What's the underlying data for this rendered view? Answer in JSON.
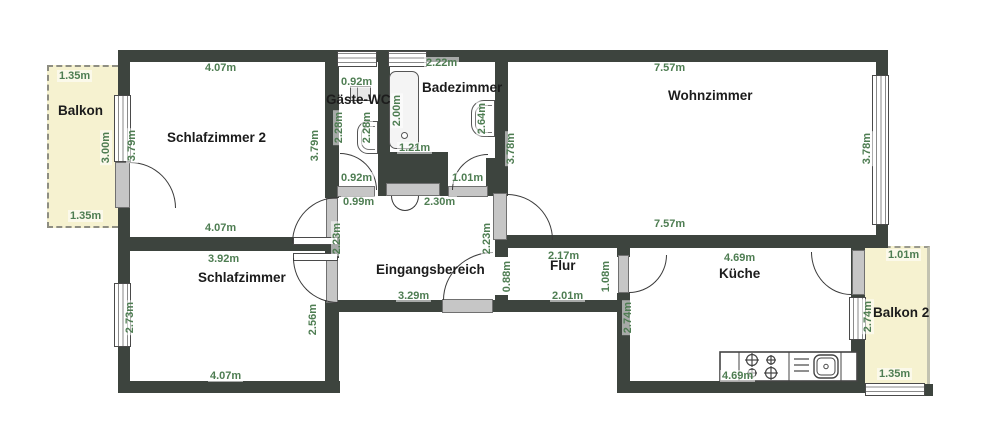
{
  "rooms": {
    "balkon": "Balkon",
    "schlafzimmer2": "Schlafzimmer 2",
    "gaeste_wc": "Gäste-WC",
    "badezimmer": "Badezimmer",
    "wohnzimmer": "Wohnzimmer",
    "eingangsbereich": "Eingangsbereich",
    "flur": "Flur",
    "kueche": "Küche",
    "schlafzimmer": "Schlafzimmer",
    "balkon2": "Balkon 2"
  },
  "dims": {
    "balkon_top": "1.35m",
    "balkon_right": "3.00m",
    "balkon_bottom": "1.35m",
    "sz2_top": "4.07m",
    "sz2_left": "3.79m",
    "sz2_right": "3.79m",
    "sz2_bottom": "4.07m",
    "wc_top": "0.92m",
    "wc_left": "2.28m",
    "wc_inner": "2.28m",
    "wc_bottom": "0.92m",
    "wc_door": "0.99m",
    "bad_top": "2.22m",
    "bad_tub": "2.00m",
    "bad_tub_w": "1.21m",
    "bad_right": "2.64m",
    "bad_bottom": "1.01m",
    "entry_top": "2.30m",
    "wz_top": "7.57m",
    "wz_left": "3.78m",
    "wz_right": "3.78m",
    "wz_bottom": "7.57m",
    "entry_left": "2.23m",
    "entry_right": "2.23m",
    "entry_bottom": "3.29m",
    "sz_top": "3.92m",
    "sz_left": "2.73m",
    "sz_right": "2.56m",
    "sz_bottom": "4.07m",
    "flur_top": "2.17m",
    "flur_left": "0.88m",
    "flur_right": "1.08m",
    "flur_bottom": "2.01m",
    "kueche_top": "4.69m",
    "kueche_left": "2.74m",
    "kueche_bottom": "4.69m",
    "balkon2_top": "1.01m",
    "balkon2_left": "2.74m",
    "balkon2_bottom": "1.35m"
  },
  "colors": {
    "wall": "#3d443e",
    "dimension_text": "#4e7d52",
    "balcony_fill": "#f6f2d0",
    "door_sill": "#c6c6c6",
    "room_text": "#1c1c1c"
  }
}
